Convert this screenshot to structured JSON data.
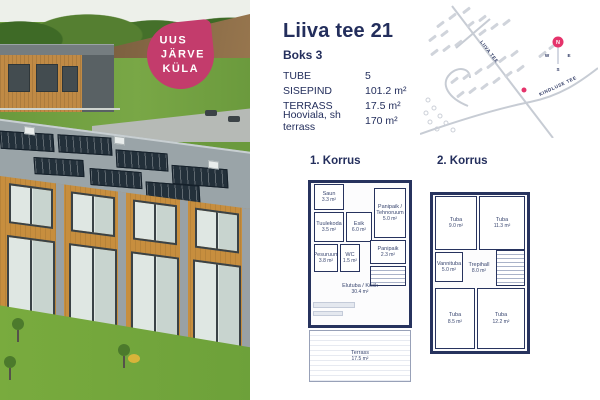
{
  "photo": {
    "badge": {
      "lines": [
        "UUS",
        "JÄRVE",
        "KÜLA"
      ],
      "color": "#c33c6c"
    }
  },
  "details": {
    "title": "Liiva tee 21",
    "subtitle": "Boks 3",
    "specs": [
      {
        "label": "TUBE",
        "value": "5"
      },
      {
        "label": "SISEPIND",
        "value": "101.2 m²"
      },
      {
        "label": "TERRASS",
        "value": "17.5 m²"
      },
      {
        "label": "Hooviala, sh terrass",
        "value": "170 m²"
      }
    ]
  },
  "map": {
    "road_labels": [
      "LIIVA TEE",
      "KINDLUSE TEE"
    ],
    "compass": {
      "n": "N",
      "e": "E",
      "s": "S",
      "w": "W"
    },
    "marker_color": "#e5336b"
  },
  "floorplans": [
    {
      "title": "1. Korrus",
      "rooms": [
        {
          "name": "Saun",
          "area": "3.3 m²"
        },
        {
          "name": "Tuulekoda",
          "area": "3.5 m²"
        },
        {
          "name": "Esik",
          "area": "6.0 m²"
        },
        {
          "name": "Panipaik / Tehnoruum",
          "area": "5.0 m²"
        },
        {
          "name": "Pesuruum",
          "area": "3.8 m²"
        },
        {
          "name": "WC",
          "area": "1.5 m²"
        },
        {
          "name": "Panipaik",
          "area": "2.3 m²"
        },
        {
          "name": "Elutuba / Köök",
          "area": "30.4 m²"
        },
        {
          "name": "Terrass",
          "area": "17.5 m²"
        }
      ]
    },
    {
      "title": "2. Korrus",
      "rooms": [
        {
          "name": "Tuba",
          "area": "9.0 m²"
        },
        {
          "name": "Tuba",
          "area": "11.3 m²"
        },
        {
          "name": "Vannituba",
          "area": "5.0 m²"
        },
        {
          "name": "Trepihall",
          "area": "8.0 m²"
        },
        {
          "name": "Tuba",
          "area": "8.5 m²"
        },
        {
          "name": "Tuba",
          "area": "12.2 m²"
        }
      ]
    }
  ],
  "colors": {
    "navy": "#232e5c",
    "accent_pink": "#c33c6c",
    "marker_pink": "#e5336b"
  }
}
